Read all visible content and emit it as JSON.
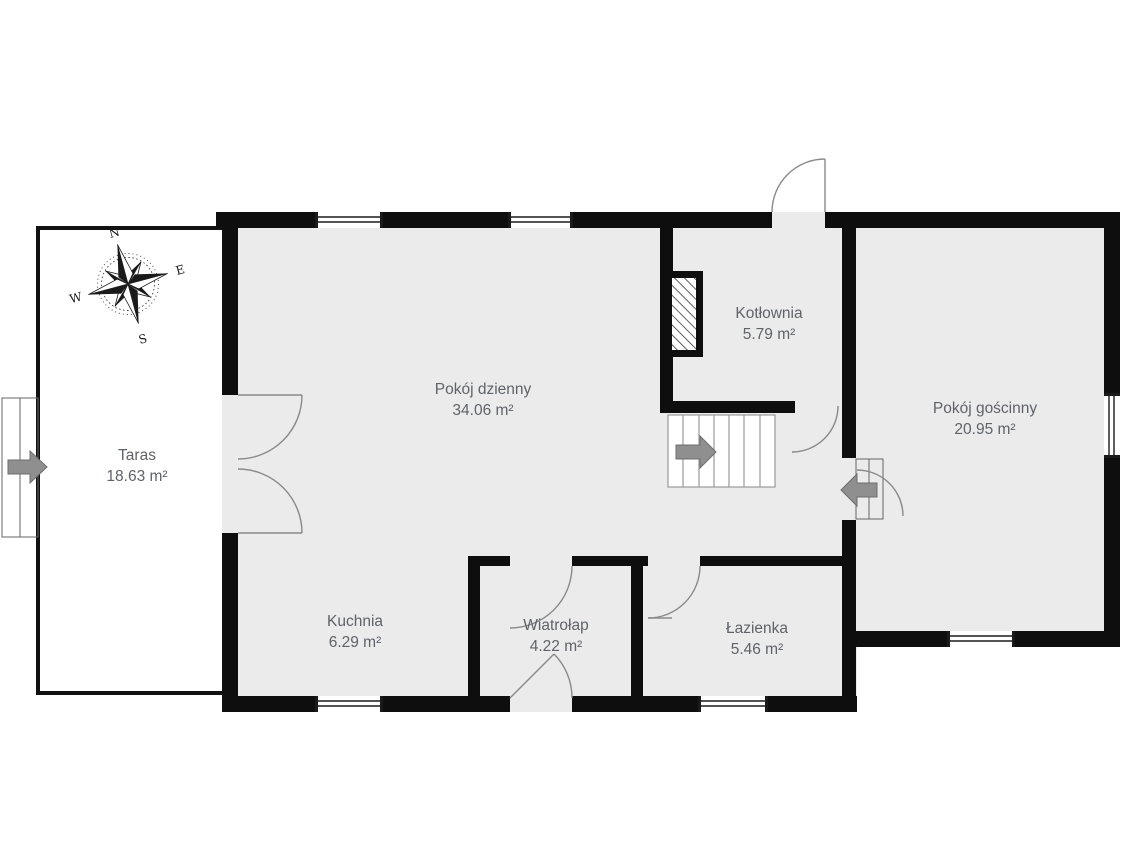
{
  "rooms": [
    {
      "id": "taras",
      "name": "Taras",
      "area": "18.63 m²"
    },
    {
      "id": "pokoj-dzienny",
      "name": "Pokój dzienny",
      "area": "34.06 m²"
    },
    {
      "id": "kotlownia",
      "name": "Kotłownia",
      "area": "5.79 m²"
    },
    {
      "id": "pokoj-goscinny",
      "name": "Pokój gościnny",
      "area": "20.95 m²"
    },
    {
      "id": "kuchnia",
      "name": "Kuchnia",
      "area": "6.29 m²"
    },
    {
      "id": "wiatrolap",
      "name": "Wiatrołap",
      "area": "4.22 m²"
    },
    {
      "id": "lazienka",
      "name": "Łazienka",
      "area": "5.46 m²"
    }
  ],
  "compass": {
    "north": "N",
    "east": "E",
    "south": "S",
    "west": "W"
  },
  "colors": {
    "background": "#ffffff",
    "floor": "#ebebeb",
    "wall": "#0e0e0e",
    "terrace_wall": "#111111",
    "window_line": "#1a1a1a",
    "door": "#8a8a8a",
    "stairs_line": "#9a9a9a",
    "arrow": "#8f8f8f",
    "arrow_edge": "#6e6e6e",
    "label": "#5f6368"
  }
}
